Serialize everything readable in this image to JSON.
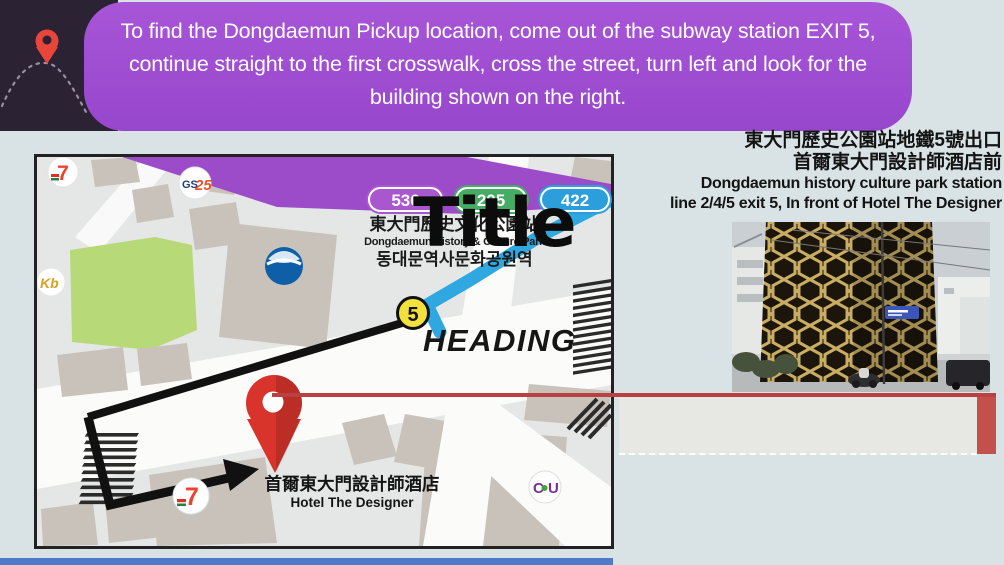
{
  "banner": {
    "lines": [
      "To find the Dongdaemun Pickup location, come out of the subway station EXIT 5,",
      "continue straight to the first crosswalk, cross the street, turn left and look for the",
      "building shown on the right."
    ]
  },
  "caption": {
    "lines": [
      "東大門歷史公園站地鐵5號出口",
      "首爾東大門設計師酒店前",
      "Dongdaemun history culture park station",
      "line 2/4/5 exit 5, In front of Hotel The Designer"
    ]
  },
  "map": {
    "bus_routes": [
      {
        "label": "536",
        "color": "#a957cf"
      },
      {
        "label": "205",
        "color": "#44ad63"
      },
      {
        "label": "422",
        "color": "#2b9edb"
      }
    ],
    "station": {
      "zh": "東大門歷史文化公園站",
      "en": "Dongdaemun History & Culture Park",
      "ko": "동대문역사문화공원역"
    },
    "exit_badge": "5",
    "hotel": {
      "zh": "首爾東大門設計師酒店",
      "en": "Hotel The Designer"
    },
    "logos": {
      "seven_eleven_top": "7",
      "gs25_gs": "GS",
      "gs25_25": "25",
      "kb": "Kb",
      "seven_eleven_bottom": "7",
      "cu_c": "C",
      "cu_u": "U"
    }
  },
  "overlays": {
    "title": "Title",
    "heading": "HEADING"
  },
  "colors": {
    "banner_purple": "#a04fd4",
    "header_dark": "#2b2233",
    "map_band_purple": "#9d4cc9",
    "road_blue": "#2fa7e0",
    "exit_yellow": "#f2e03c",
    "pin_red": "#d8342c",
    "connector_red": "#b84242",
    "bottom_bar_blue": "#4f79c9",
    "park_green": "#b8d977"
  }
}
